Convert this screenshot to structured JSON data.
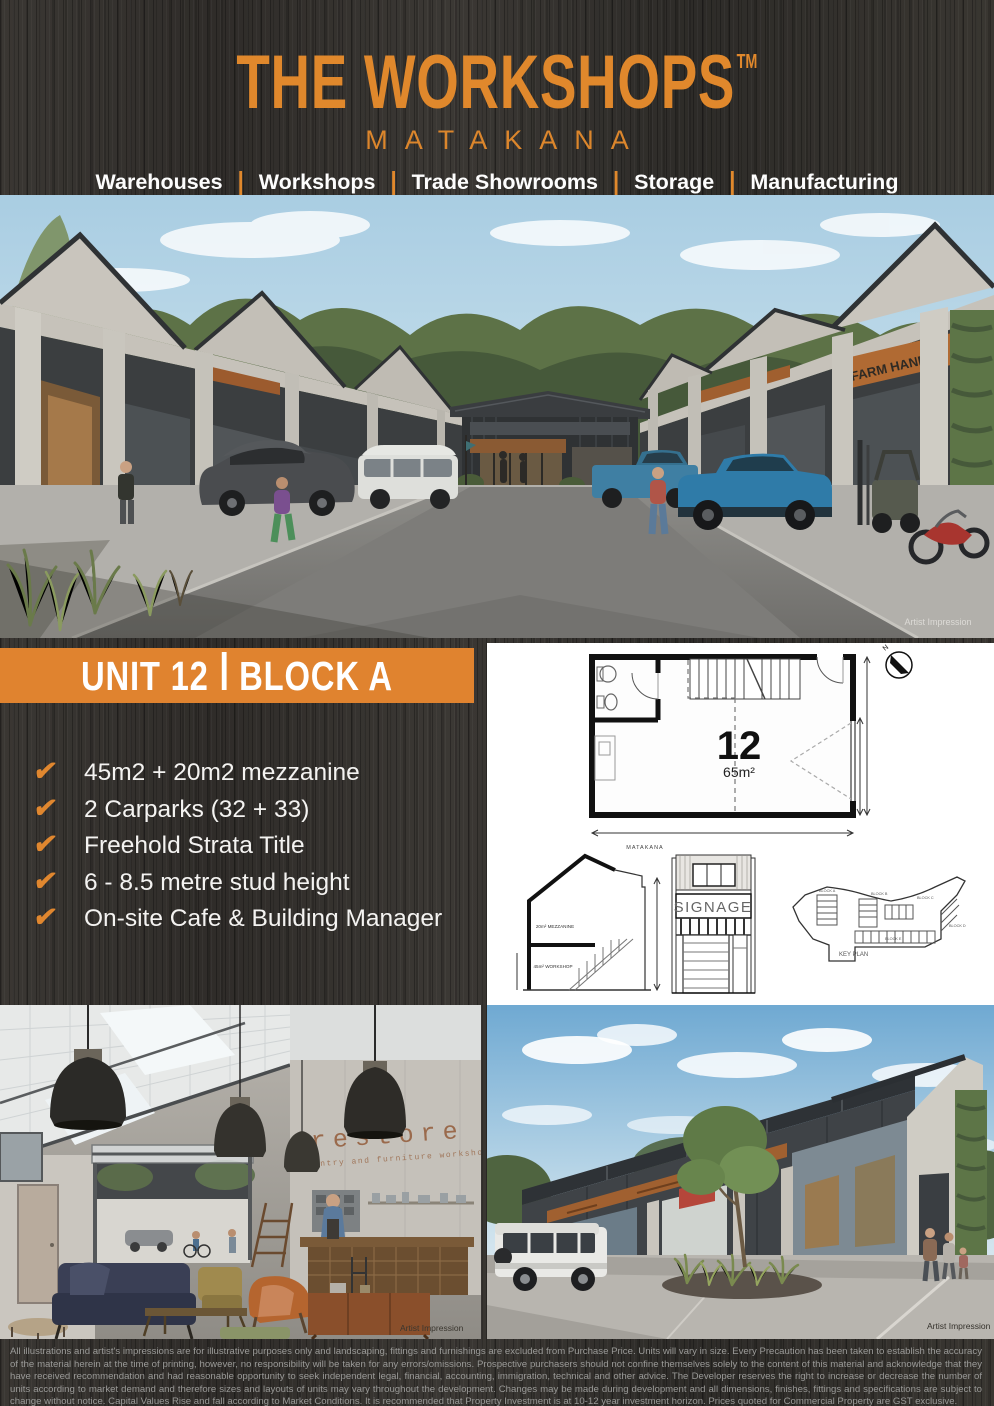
{
  "brand": {
    "title": "THE WORKSHOPS",
    "trademark": "TM",
    "location": "MATAKANA",
    "categories": [
      "Warehouses",
      "Workshops",
      "Trade Showrooms",
      "Storage",
      "Manufacturing"
    ]
  },
  "hero": {
    "caption": "Artist Impression",
    "signage_farm_hand": "FARM HAND"
  },
  "unit": {
    "banner_unit": "UNIT 12",
    "banner_block": "BLOCK A",
    "check": "✔",
    "features": [
      "45m2 + 20m2 mezzanine",
      "2 Carparks (32 + 33)",
      "Freehold Strata Title",
      "6 - 8.5 metre stud height",
      "On-site Cafe & Building Manager"
    ]
  },
  "plan": {
    "unit_number": "12",
    "area": "65m²",
    "compass": "N",
    "matakana_label": "MATAKANA",
    "mezzanine_label": "20m² MEZZANINE",
    "workshop_label": "45m² WORKSHOP",
    "signage_label": "SIGNAGE",
    "key_plan_label": "KEY PLAN",
    "block_labels": [
      "BLOCK A",
      "BLOCK B",
      "BLOCK C",
      "BLOCK D",
      "BLOCK E"
    ]
  },
  "interior": {
    "sign_title": "restore",
    "sign_subtitle": "carpentry and furniture workshop",
    "caption": "Artist Impression"
  },
  "exterior": {
    "caption": "Artist Impression"
  },
  "disclaimer": "All illustrations and artist's impressions are for illustrative purposes only and landscaping, fittings and furnishings are excluded from Purchase Price.  Units will vary in size.  Every Precaution has been taken to establish the accuracy of the material herein at the time of printing, however, no responsibility will be taken for any errors/omissions.  Prospective purchasers should not confine themselves solely to the content of this material and acknowledge that they have received recommendation and had reasonable opportunity to seek independent legal, financial, accounting, immigration, technical and other advice.  The Developer reserves the right to increase or decrease the number of units according to market demand and therefore sizes and layouts of units may vary throughout the development.  Changes may be made during development and all dimensions, finishes, fittings and specifications are subject to change without notice. Capital Values Rise and fall according to Market Conditions. It is recommended that Property Investment is at 10-12 year investment horizon. Prices quoted for Commercial Property are GST exclusive.",
  "colors": {
    "accent_orange": "#e0832f",
    "background_dark": "#343230",
    "disclaimer_gray": "#9a9a98"
  }
}
